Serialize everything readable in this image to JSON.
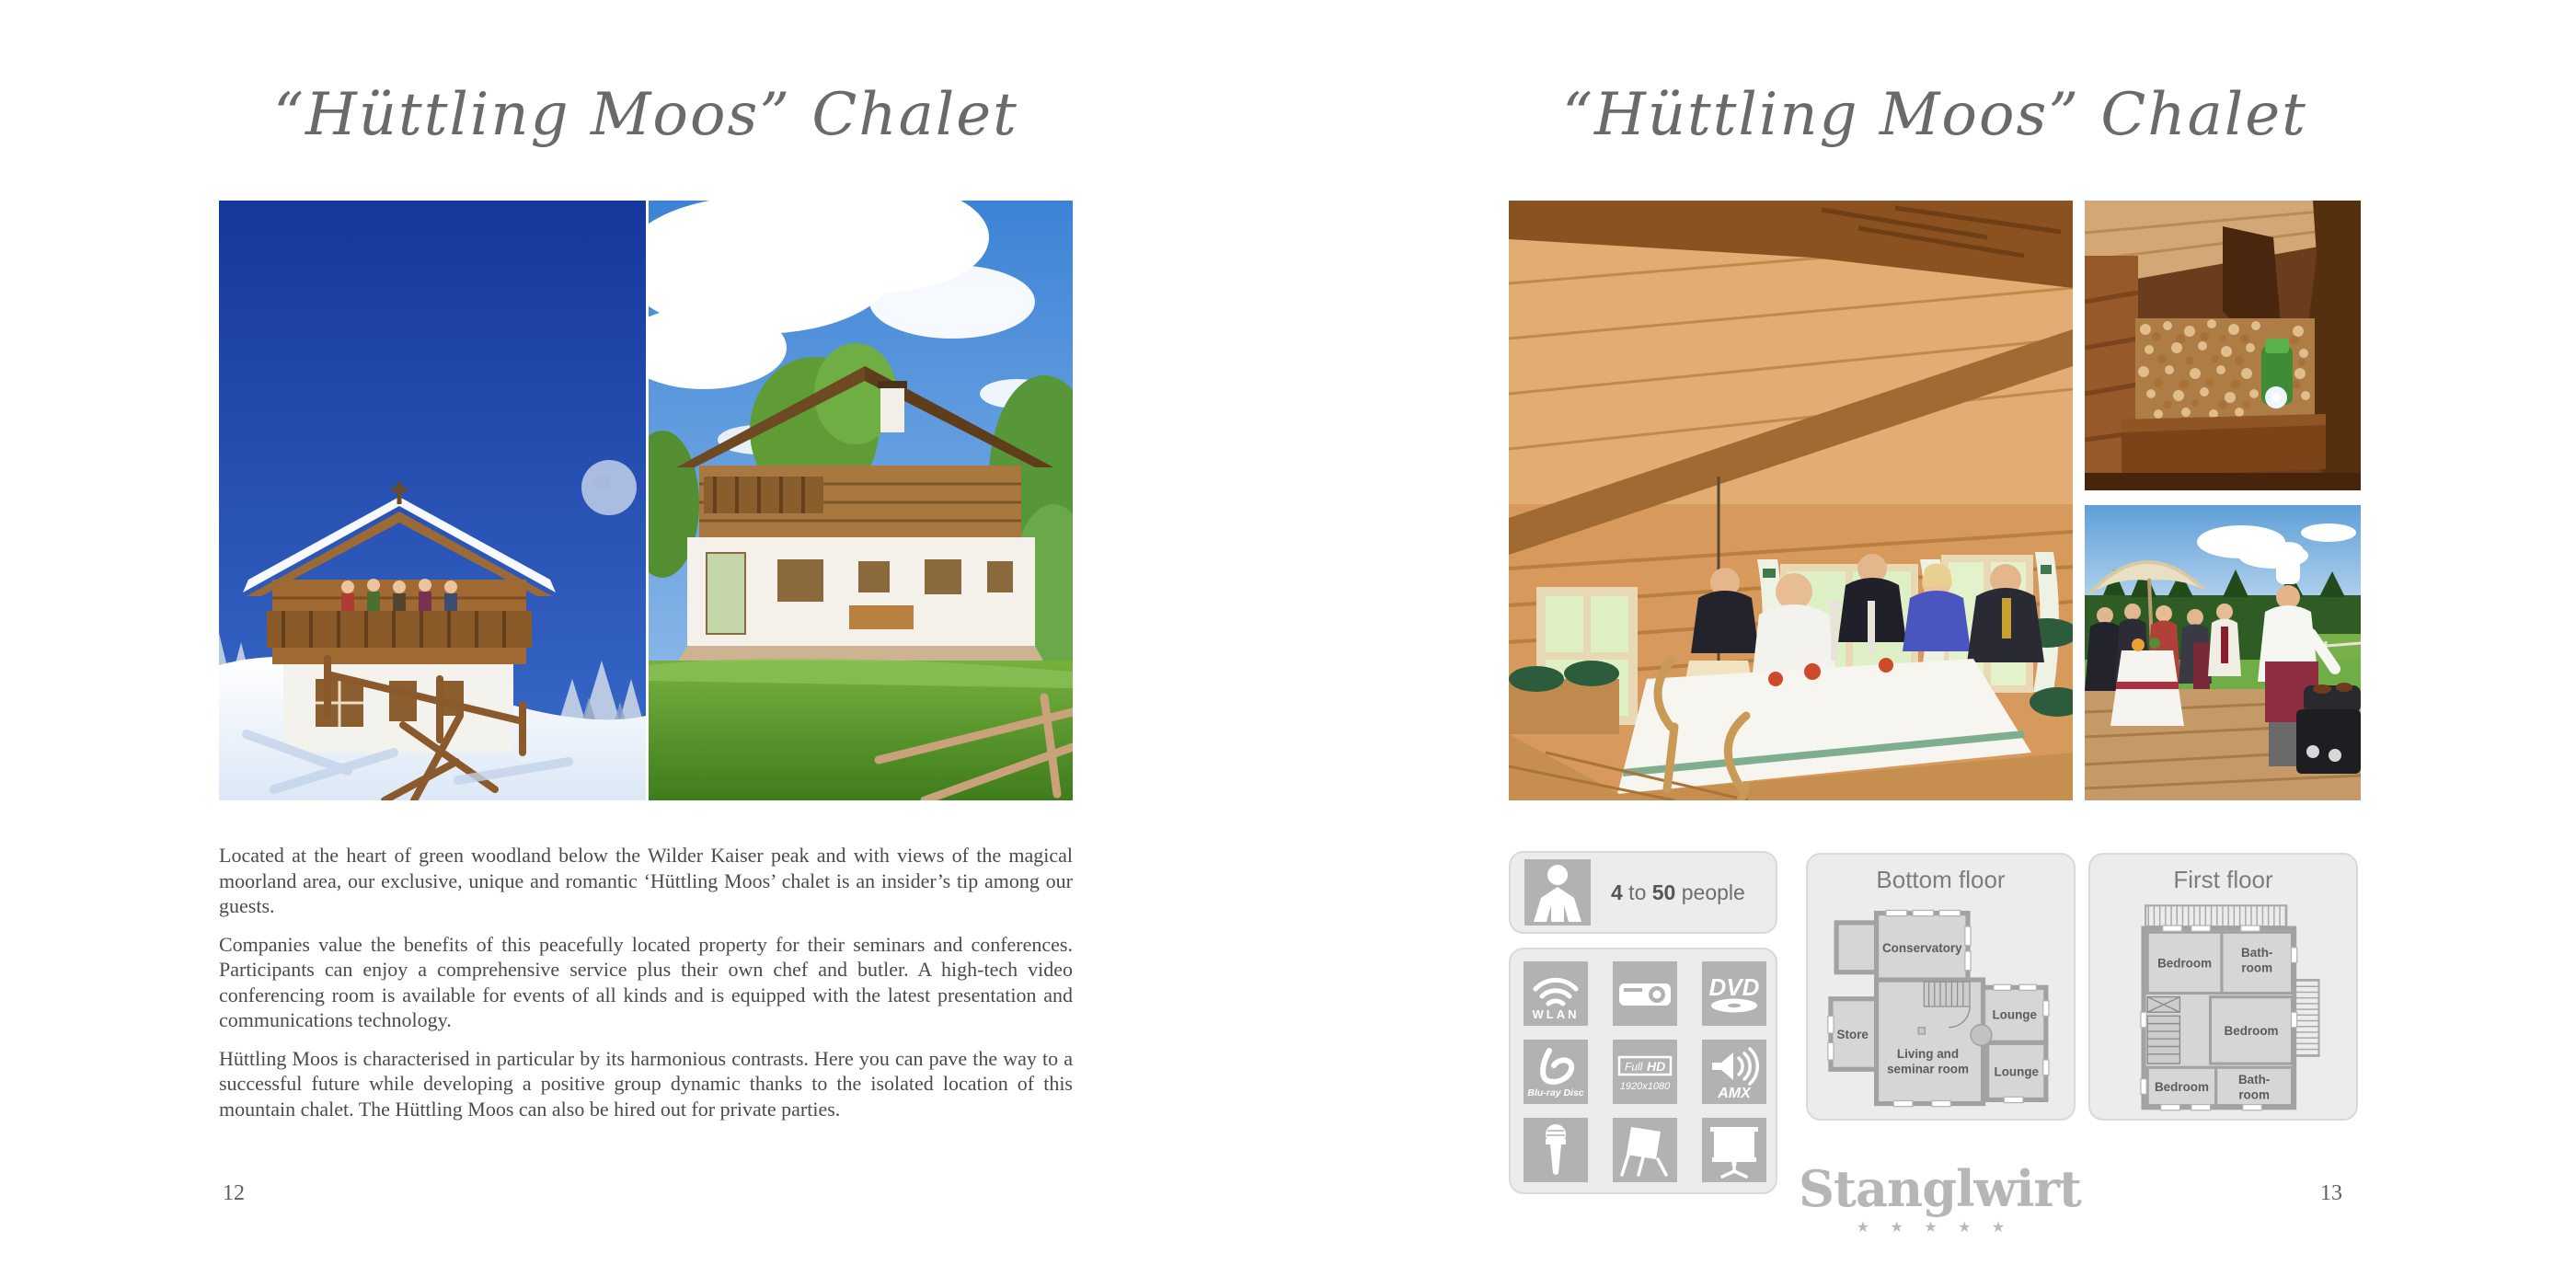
{
  "left_page": {
    "title": "“Hüttling Moos” Chalet",
    "photos": [
      "winter-chalet-exterior",
      "summer-chalet-exterior"
    ],
    "paragraphs": [
      "Located at the heart of green woodland below the Wilder Kaiser peak and with views of the magical moorland area, our exclusive, unique and romantic ‘Hüttling Moos’ chalet is an insider’s tip among our guests.",
      "Companies value the benefits of this peacefully located property for their seminars and conferences. Participants can enjoy a comprehensive service plus their own chef and butler. A high-tech video conferencing room is available for events of all kinds and is equipped with the latest presentation and communications technology.",
      "Hüttling Moos is characterised in particular by its harmonious contrasts. Here you can pave the way to a successful future while developing a positive group dynamic thanks to the isolated location of this mountain chalet. The Hüttling Moos can also be hired out for private parties."
    ],
    "page_number": "12"
  },
  "right_page": {
    "title": "“Hüttling Moos” Chalet",
    "photos": [
      "dining-room-interior",
      "firewood-stack",
      "outdoor-barbecue"
    ],
    "capacity": {
      "min": "4",
      "connector": " to ",
      "max": "50",
      "unit": " people"
    },
    "equipment_icons": [
      {
        "name": "wlan-icon",
        "label": "WLAN"
      },
      {
        "name": "projector-icon"
      },
      {
        "name": "dvd-icon",
        "label": "DVD"
      },
      {
        "name": "blu-ray-icon",
        "label": "Blu-ray Disc"
      },
      {
        "name": "full-hd-icon",
        "label1": "Full",
        "label2": "HD",
        "sublabel": "1920x1080"
      },
      {
        "name": "amx-sound-icon",
        "label": "AMX"
      },
      {
        "name": "microphone-icon"
      },
      {
        "name": "flipchart-icon"
      },
      {
        "name": "projection-screen-icon"
      }
    ],
    "floorplans": [
      {
        "title": "Bottom floor",
        "rooms": [
          [
            "Conservatory"
          ],
          [
            "Store"
          ],
          [
            "Living and",
            "seminar room"
          ],
          [
            "Lounge"
          ],
          [
            "Lounge"
          ]
        ]
      },
      {
        "title": "First floor",
        "rooms": [
          [
            "Bedroom"
          ],
          [
            "Bath-",
            "room"
          ],
          [
            "Bedroom"
          ],
          [
            "Bedroom"
          ],
          [
            "Bath-",
            "room"
          ]
        ]
      }
    ],
    "brand": {
      "name": "Stanglwirt",
      "stars": "★ ★ ★ ★ ★"
    },
    "page_number": "13"
  }
}
